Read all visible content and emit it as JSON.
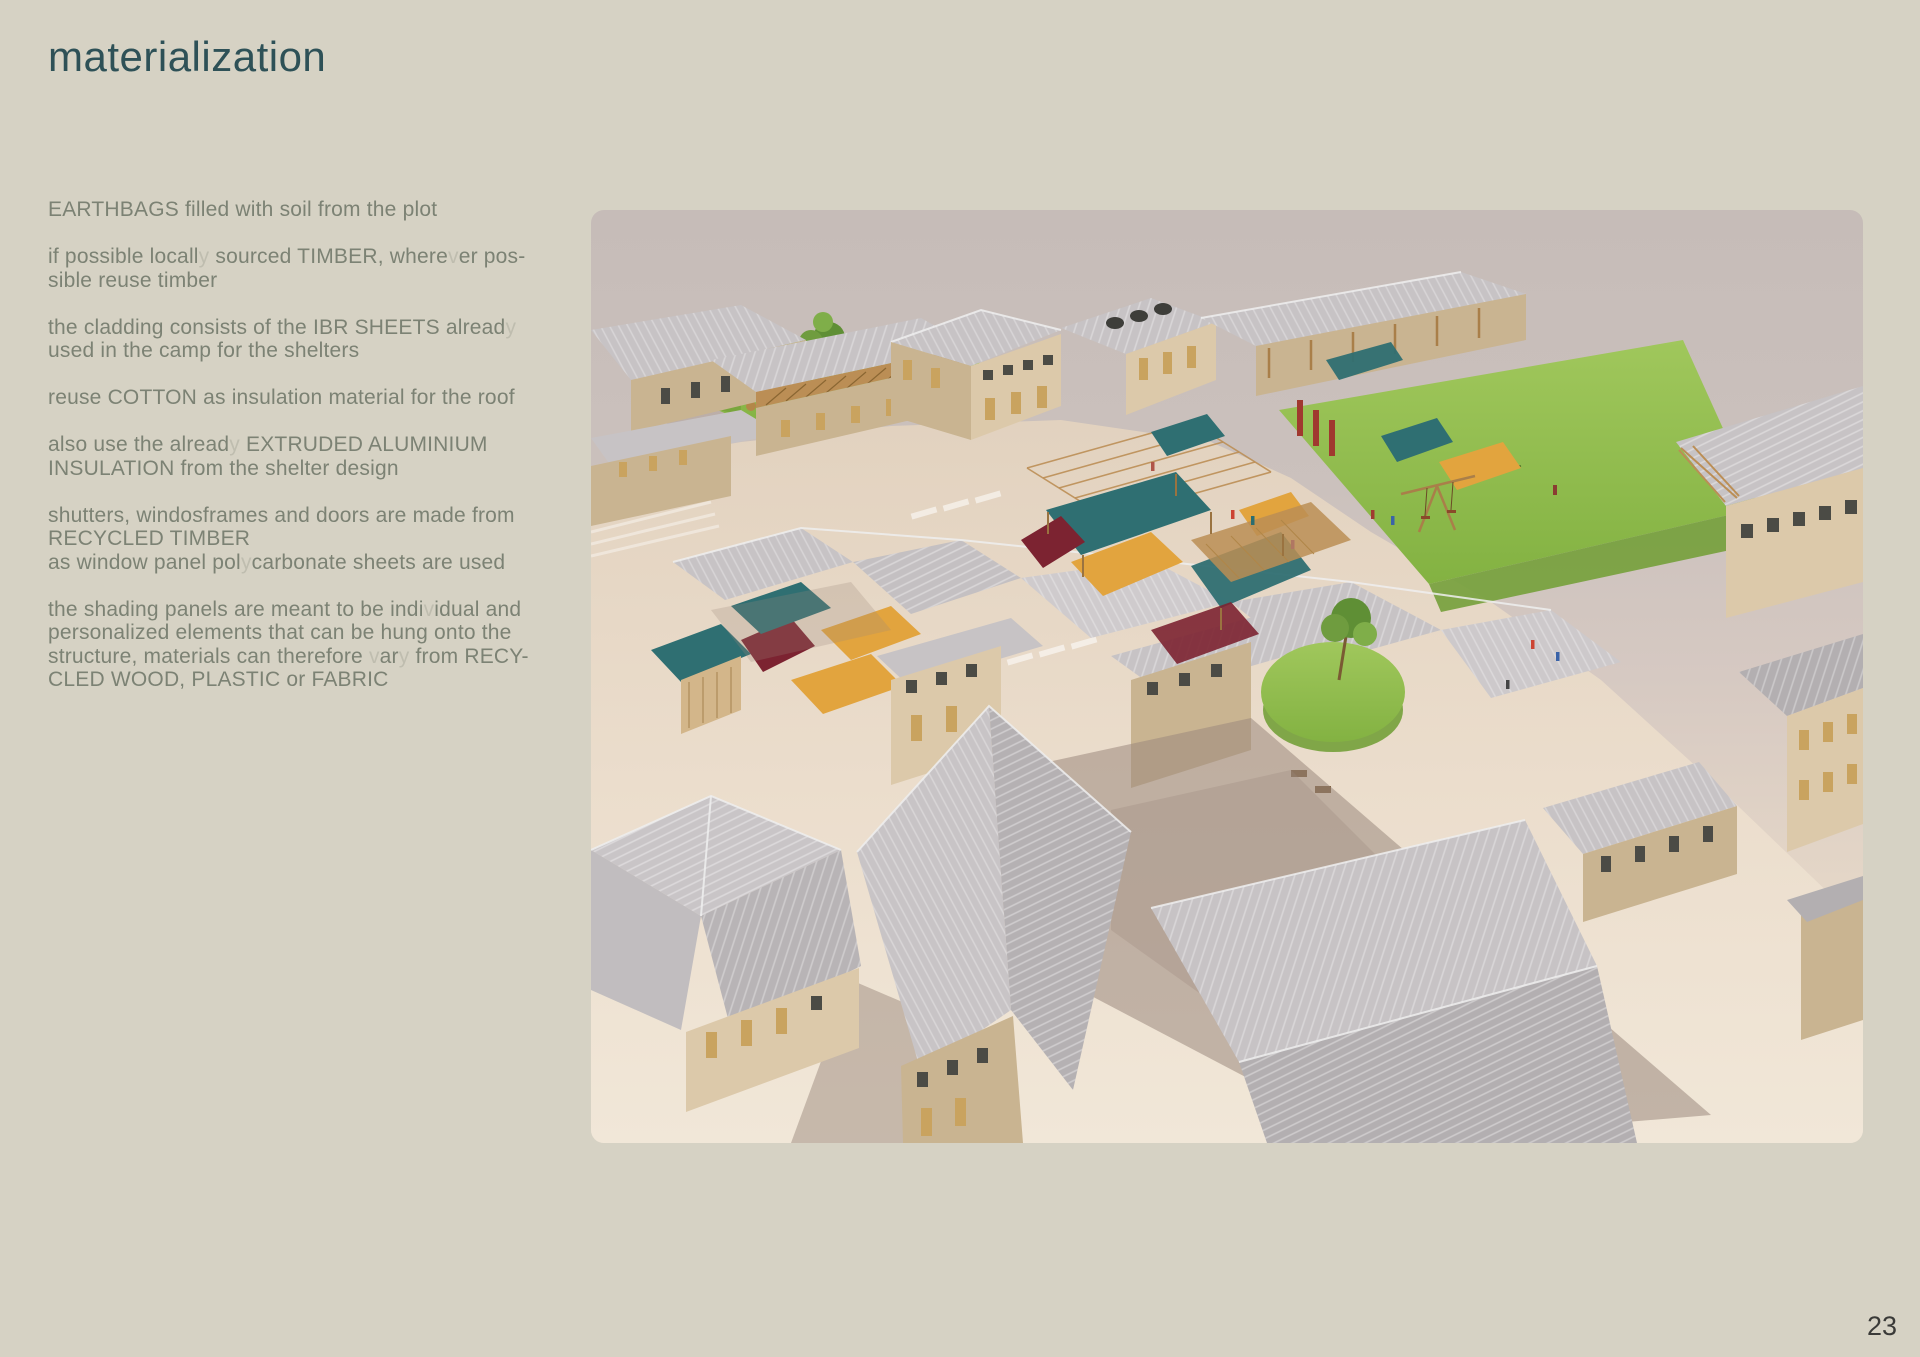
{
  "page": {
    "title": "materialization",
    "page_number": "23"
  },
  "notes": [
    {
      "lines": [
        "EARTHBAGS filled with soil from the plot"
      ]
    },
    {
      "lines": [
        "if possible locally sourced TIMBER, wherever pos-",
        "sible reuse timber"
      ]
    },
    {
      "lines": [
        "the cladding consists of the IBR SHEETS already",
        "used in the camp for the shelters"
      ]
    },
    {
      "lines": [
        "reuse COTTON as insulation material for the roof"
      ]
    },
    {
      "lines": [
        "also use the already EXTRUDED ALUMINIUM",
        "INSULATION from the shelter design"
      ]
    },
    {
      "lines": [
        "shutters, windosframes and doors are made from",
        "RECYCLED TIMBER",
        "as window panel polycarbonate sheets are used"
      ]
    },
    {
      "lines": [
        "the shading panels are meant to be individual and",
        "personalized elements that can be hung onto the",
        "structure, materials can therefore vary from RECY-",
        "CLED WOOD, PLASTIC or FABRIC"
      ]
    }
  ],
  "render": {
    "alt": "Aerial 3D rendering of a school village: beige earthbag buildings with corrugated IBR sheet roofs, timber pergolas, colorful fabric shading panels in teal, ochre and maroon, green lawns and a playground",
    "colors": {
      "bg": "#d6d2c4",
      "title": "#2e5157",
      "text": "#7c8274",
      "page_num": "#3a3a38",
      "sky": "#c8bebb",
      "sand": "#e8dbcb",
      "roof": "#c7c3c5",
      "roof_dark": "#b3afb1",
      "wall": "#dcc9aa",
      "wall_shade": "#c9b491",
      "lawn": "#93bd50",
      "lawn_dark": "#74a03a",
      "teal": "#2f6f72",
      "ochre": "#e2a43e",
      "maroon": "#7c2331",
      "timber": "#bb8e55",
      "shadow": "#9b897d"
    }
  }
}
